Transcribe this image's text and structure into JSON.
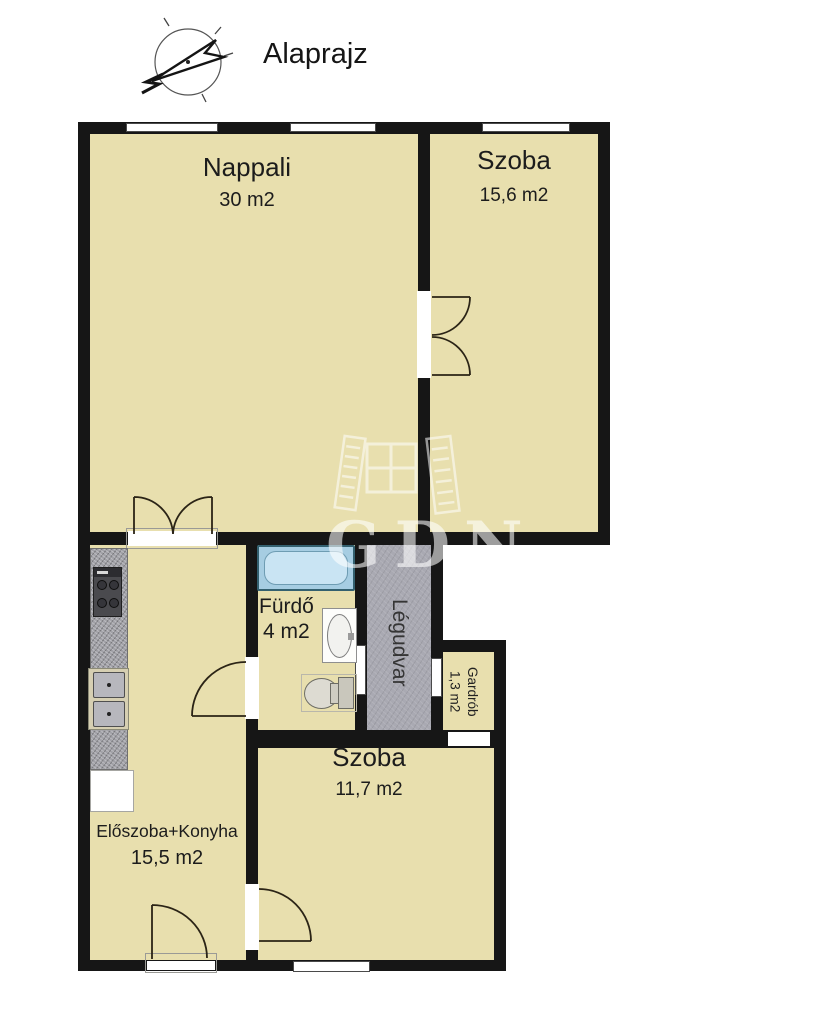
{
  "header": {
    "title": "Alaprajz",
    "compass": "north-arrow"
  },
  "watermark": {
    "text": "GDN"
  },
  "rooms": {
    "nappali": {
      "name": "Nappali",
      "area": "30 m2"
    },
    "szoba_felso": {
      "name": "Szoba",
      "area": "15,6 m2"
    },
    "furdo": {
      "name": "Fürdő",
      "area": "4 m2"
    },
    "legudvar": {
      "name": "Légudvar"
    },
    "gardrob": {
      "name": "Gardrób",
      "area": "1,3 m2"
    },
    "szoba_also": {
      "name": "Szoba",
      "area": "11,7 m2"
    },
    "eloszoba_konyha": {
      "name": "Előszoba+Konyha",
      "area": "15,5 m2"
    }
  },
  "fixtures": [
    "bathtub",
    "washbasin",
    "toilet",
    "gas-stove",
    "kitchen-sink",
    "kitchen-counter",
    "cabinet"
  ],
  "colors": {
    "floor": "#e8dfae",
    "wall": "#161616",
    "light_well": "#a9a9b2",
    "bathtub": "#a6cde2",
    "watermark": "rgba(255,255,255,0.58)"
  }
}
